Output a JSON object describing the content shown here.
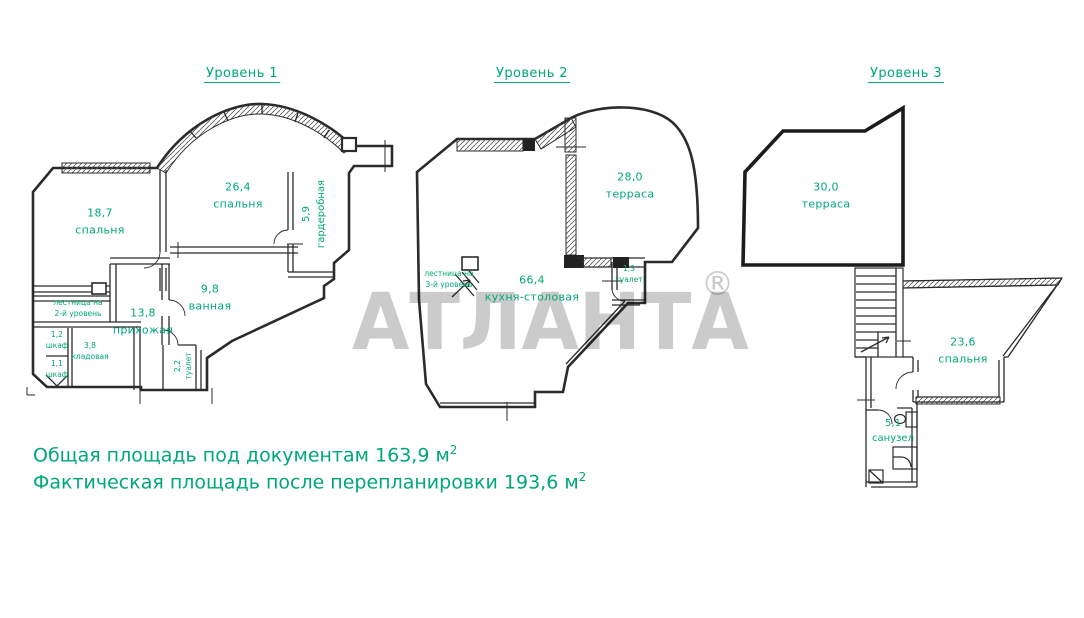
{
  "colors": {
    "label_green": "#00a878",
    "line": "#2b2b2b",
    "watermark_gray": "#c7c7c7",
    "background": "#ffffff"
  },
  "watermark": {
    "text": "АТЛАНТА",
    "reg": "®"
  },
  "levels": [
    {
      "title": "Уровень 1",
      "rooms": [
        {
          "area": "18,7",
          "name": "спальня"
        },
        {
          "area": "26,4",
          "name": "спальня"
        },
        {
          "area": "5,9",
          "name": "гардеробная"
        },
        {
          "area": "9,8",
          "name": "ванная"
        },
        {
          "area": "13,8",
          "name": "прихожая"
        },
        {
          "name": "лестница на",
          "name2": "2-й уровень"
        },
        {
          "area": "1,2",
          "name": "шкаф"
        },
        {
          "area": "3,8",
          "name": "кладовая"
        },
        {
          "area": "1,1",
          "name": "шкаф"
        },
        {
          "area": "2,2",
          "name": "туалет"
        }
      ]
    },
    {
      "title": "Уровень 2",
      "rooms": [
        {
          "area": "28,0",
          "name": "терраса"
        },
        {
          "area": "66,4",
          "name": "кухня-столовая"
        },
        {
          "name": "лестница на",
          "name2": "3-й уровень"
        },
        {
          "area": "1,3",
          "name": "туалет"
        }
      ]
    },
    {
      "title": "Уровень 3",
      "rooms": [
        {
          "area": "30,0",
          "name": "терраса"
        },
        {
          "area": "23,6",
          "name": "спальня"
        },
        {
          "area": "5,1",
          "name": "санузел"
        }
      ]
    }
  ],
  "footer": {
    "line1": {
      "text": "Общая площадь под документам 163,9 м",
      "sup": "2"
    },
    "line2": {
      "text": "Фактическая площадь после перепланировки 193,6 м",
      "sup": "2"
    }
  }
}
